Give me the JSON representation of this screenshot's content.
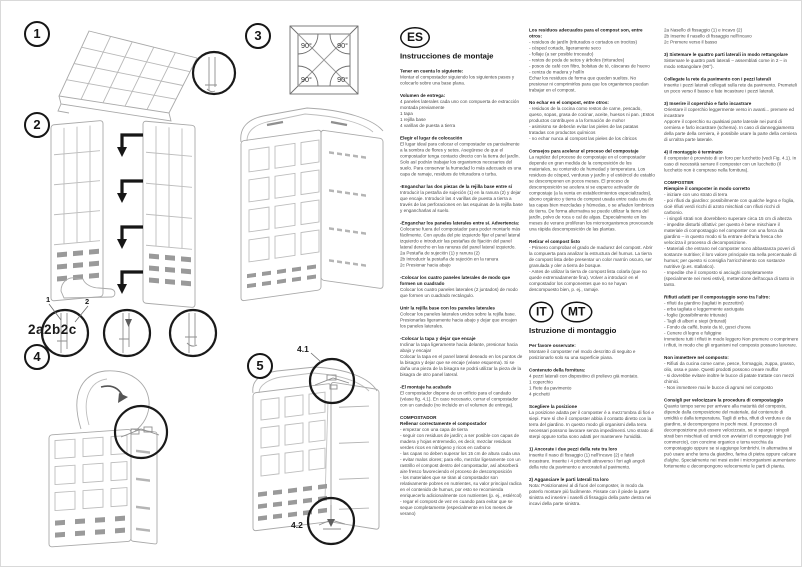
{
  "diagrams": {
    "step_badges": [
      "1",
      "2",
      "3",
      "4",
      "5"
    ],
    "joint_detail_label": "2a2b2c",
    "callout_labels": [
      "1",
      "2"
    ],
    "angle_labels": [
      "90°",
      "90°",
      "90°",
      "90°"
    ],
    "fig_labels": [
      "4.1",
      "4.2"
    ]
  },
  "columns": {
    "col1": {
      "lang_badge": "ES",
      "title": "Instrucciones de montaje",
      "blocks": [
        {
          "t": "Tener en cuenta lo siguiente:",
          "b": "Montar el compostador siguiendo los siguientes pasos y colocarlo sobre una base plana."
        },
        {
          "t": "Volumen de entrega:",
          "b": "4 paneles laterales cada uno con compuerta de extracción montada previamente\n1 tapa\n1 rejilla base\n4 varillas de puesta a tierra"
        },
        {
          "t": "Elegir el lugar de colocación",
          "b": "El lugar ideal para colocar el compostador es parcialmente a la sombra de flores y setos. Asegúrese de que el compostador tenga contacto directo con la tierra del jardín. Solo así podrán trabajar los organismos necesarios del suelo. Para conservar la humedad lo más adecuado es una capa de ramaje, residuos de trituradora o turba."
        },
        {
          "t": "-Enganchar las dos piezas de la rejilla base entre sí",
          "b": "Introducir la pestaña de sujeción (1) en la ranura (2) y dejar que encaje. Introducir las 4 varillas de puesta a tierra a través de las perforaciones en las esquinas de la rejilla base y engancharlas al suelo."
        },
        {
          "t": "-Enganchar los paneles laterales entre sí. Advertencia:",
          "b": "Colocarse fuera del compostador para poder montarlo más fácilmente. Con ayuda del pie izquierdo fijar el panel lateral izquierdo e introducir las pestañas de fijación del panel lateral derecho en las ranuras del panel lateral izquierdo.\n2a Pestaña de sujeción (1) y ranura (2)\n2b Introducir la pestaña de sujeción en la ranura\n2c Presionar hacia abajo"
        },
        {
          "t": "-Colocar los cuatro paneles laterales de modo que formen un cuadrado",
          "b": "Colocar los cuatro paneles laterales (2 juntados) de modo que formen un cuadrado rectángulo."
        },
        {
          "t": "Unir la rejilla base con los paneles laterales",
          "b": "Colocar los paneles laterales unidos sobre la rejilla base. Presionarlas ligeramente hacia abajo y dejar que encajen los paneles laterales."
        },
        {
          "t": "-Colocar la tapa y dejar que encaje",
          "b": "Inclinar la tapa ligeramente hacia delante, presionar hacia abajo y encajar\nColocar la tapa en el panel lateral deseado en los puntos de la bisagra y dejar que se encaje (véase esquema). Si se daña una pieza de la bisagra se podrá utilizar la pieza de la bisagra de otro panel lateral."
        },
        {
          "t": "-El montaje ha acabado",
          "b": "El compostador dispone de un orificio para el candado (véase fig. 4.1). En caso necesario, cerrar el compostador con un candado (no incluido en el volumen de entrega)."
        },
        {
          "t": "COMPOSTADOR\nRellenar correctamente el compostador",
          "b": "- empezar con una capa de tierra\n- seguir con residuos de jardín; a ser posible con capas de madera y hojas entremedio, es decir, mezclar residuos verdes ricos en nitrógeno y ricos en carbono\n- las capas no deben superar los 15 cm de altura cada una\n- evitar malos olores; para ello, mezclar ligeramente con un rastrillo el compost dentro del compostador, así absorberá aire fresco favoreciendo el proceso de descomposición\n- los materiales que se tiran al compostador son relativamente pobres en nutrientes, su valor principal radica en el contenido de humus, por esto se recomienda enriquecerlo adicionalmente con nutrientes (p. ej., estiércol)\n- regar el compost de vez en cuando para evitar que se seque completamente (especialmente en los meses de verano)"
        }
      ]
    },
    "col2": {
      "blocks_es": [
        {
          "t": "Los residuos adecuados para el compost son, entre otros:",
          "b": "- residuos de jardín (triturados o cortados en trocitos)\n- césped cortado, ligeramente seco\n- follaje (a ser posible troceado)\n- restos de poda de setos y árboles (triturados)\n- posos de café con filtro, bolsitas de té, cáscaras de huevo\n- ceniza de madera y hollín\nEchar los residuos de forma que queden sueltos. No presionar ni comprimirlos para que los organismos puedan trabajar en el compost."
        },
        {
          "t": "No echar en el compost, entre otros:",
          "b": "- residuos de la cocina como restos de carne, pescado, queso, sopas, grasa de cocinar, aceite, huesos ni pan. ¡Estos productos contribuyen a la formación de moho!\n- asimismo se deberán evitar las pieles de las patatas tratadas con productos químicos\n- no echar nunca al compost las pieles de los cítricos"
        },
        {
          "t": "Consejos para acelerar el proceso del compostaje",
          "b": "La rapidez del proceso de compostaje en el compostador depende en gran medida de la composición de los materiales, su contenido de humedad y temperatura. Los residuos de césped, verduras y jardín y el estiércol de establo se descomponen en pocos meses. El proceso de descomposición se acelera si se esparce activador de compostaje (a la venta en establecimientos especializados), abono orgánico y tierra de compost usada entre cada una de las capas bien mezcladas y húmedas, o se añaden lombrices de tierra. De forma alternativa se puede utilizar la tierra del jardín, polvo de roca o cal de algas. Especialmente en los meses de verano proliferan los microorganismos provocando una rápida descomposición de las plantas."
        },
        {
          "t": "Retirar el compost listo",
          "b": "- Primero comprobar el grado de madurez del compost. Abrir la compuerta para analizar la estructura del humus. La tierra de compost lista debe presentar un color marrón oscuro, ser granulada y oler a tierra de bosque.\n- Antes de utilizar la tierra de compost lista colarla (que no quede extremadamente fina). Volver a introducir en el compostador los componentes que no se hayan descompuesto bien, p. ej., ramaje."
        }
      ],
      "lang_badges": [
        "IT",
        "MT"
      ],
      "title": "Istruzione di montaggio",
      "blocks_it": [
        {
          "t": "Per favore osservate:",
          "b": "Montare il composter nel modo descritto di seguito e posizionarlo solo su una superficie piana."
        },
        {
          "t": "Contenuto della fornitura:",
          "b": "4 pezzi laterali con dispositivo di prelievo già montato.\n1 coperchio\n1 Rete da pavimento\n4 picchetti"
        },
        {
          "t": "Scegliere la posizione",
          "b": "La posizione adatta per il composter è a mezz'ombra di fiori e siepi. Fare sì che il composter abbia il contatto diretto con la terra del giardino. In questo modo gli organismi della terra necessari possono lavorare senza impedimenti. Uno strato di sterpi oppure torba sono adatti per mantenere l'umidità."
        },
        {
          "t": "1) Ancorate i due pezzi della rete tra loro",
          "b": "Inserite il naso di fissaggio (1) nell'incavo (2) e fateli incastrare. Inserite i 4 picchetti attraverso i fori agli angoli della rete da pavimento e ancorateli al pavimento."
        },
        {
          "t": "2) Agganciare le parti laterali tra loro",
          "b": "Nota: Posizionatevi al di fuori del composter, in modo da poterlo montare più facilmente. Fissate con il piede la parte sinistra ed inserire i naselli di fissaggio della parte destra nei incavi della parte sinistra."
        }
      ]
    },
    "col3": {
      "blocks": [
        {
          "t": "",
          "b": "2a Nasello di fissaggio (1) e incavo (2)\n2b Inserire il nasello di fissaggio nell'incavo\n2c Premere verso il basso"
        },
        {
          "t": "3) Sistemare le quattro parti laterali in modo rettangolare",
          "b": "Sistemare le quattro parti laterali – assemblati come in 2 – in modo rettangolare (90°)."
        },
        {
          "t": "Collegate la rete da pavimento con i pezzi laterali",
          "b": "Inserite i pezzi laterali collegati sulla rete da pavimento. Premeteli un poco verso il basso e fate incastrare i pezzi laterali."
        },
        {
          "t": "3) Inserire il coperchio e farlo incastrare",
          "b": "Orientare il coperchio leggermente verso in avanti... premere ed incastrare\nApporre il coperchio su qualsiasi parte laterale nei punti di cerniera e farlo incastrare (schema). In caso di danneggiamento della parte della cerniera, è possibile usare la parte della cerniera di un'altra parte laterale."
        },
        {
          "t": "4) Il montaggio è terminato",
          "b": "Il composter è provvisto di un foro per lucchetto (vedi Fig. 4.1). In caso di necessità serrare il composter con un lucchetto (il lucchetto non è compreso nella fornitura)."
        },
        {
          "t": "COMPOSTER\nRiempire il composter in modo corretto",
          "b": "- iniziare con uno strato di terra\n- poi rifiuti da giardino: possibilmente con qualche legno e foglia, cioè rifiuti verdi ricchi di azoto mischiati con rifiuti ricchi di carbonio.\n- i singoli strati non dovrebbero superare circa 15 cm di altezza\n- impedite disturbi olfattivi: per questo è bene mischiare il materiale di compostaggio nel composter con una forca da giardino – in questo modo si fa entrare dell'aria fresca che velocizza il processo di decomposizione.\n- Materiali che entrano nel composter sono abbastanza poveri di sostanze nutritive; il loro valore principale sta nella percentuale di humus; per questo si consiglia l'arricchimento con sostanze nutritive (p.es. stallatico).\n- Impedite che il composto si asciughi completamente (specialmente nei mesi estivi), mettendone dell'acqua di tanto in tanto."
        },
        {
          "t": "Rifiuti adatti per il compostaggio sono tra l'altro:",
          "b": "- rifiuti da giardino (tagliati in pezzettini)\n- erba tagliata e leggermente asciugata\n- foglie (possibilmente triturate)\n- Tagli di alberi e siepi (triturati)\n- Fondo da caffè, buste da tè, gusci d'uova\n- Cenere di legno e fuliggine\nImmettere tutti i rifiuti in modo leggero Non premere o comprimere i rifiuti, in modo che gli organismi nel composto possano lavorare."
        },
        {
          "t": "Non immettere nel composto:",
          "b": "- Rifiuti da cucina come carne, pesce, formaggio, zuppa, grasso, olio, ossa e pane. Questi prodotti possono creare muffa!\n- si dovrebbe evitare inoltre le bucce di patate trattate con mezzi chimici.\n- Non immettere mai le bucce di agrumi nel composto"
        },
        {
          "t": "Consigli per velocizzare la procedura di compostaggio",
          "b": "Quanto tempo serve per arrivare alla maturità del composto, dipende dalla composizione del materiale, dal contenuto di umidità e dalla temperatura. Tagli di erba, rifiuti di verdura e da giardino, si decompongono in pochi mesi. Il processo di decomposizione può essere velocizzato, se si sparge i singoli strati ben mischiati ed umidi con avviatori di compostaggio (nel commercio), con concime organico e terra vecchia da compostaggio oppure se si aggiunge lombrichi. In alternativa si può usare anche terra da giardino, farina di pietra oppure calcare d'alghe. Specialmente nei mesi estivi i microrganismi aumentano fortemente e decompongono velocemente le parti di pianta."
        }
      ]
    }
  }
}
